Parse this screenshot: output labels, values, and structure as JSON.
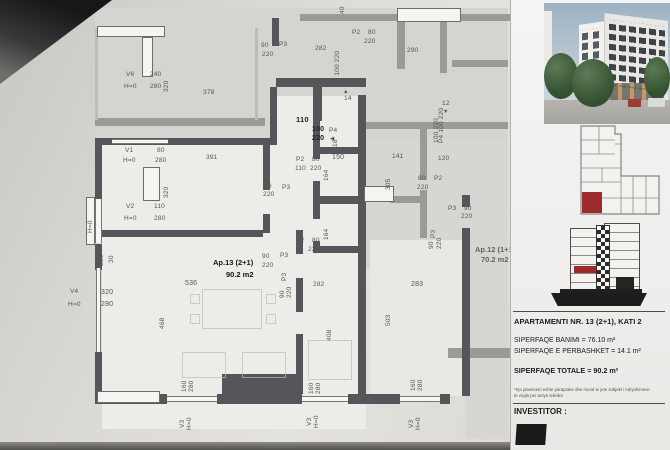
{
  "sidebar": {
    "title": "APARTAMENTI NR. 13 (2+1), KATI 2",
    "line_banimi": "SIPERFAQE BANIMI = 76.10 m²",
    "line_perbashket": "SIPERFAQE E PERBASHKET = 14.1 m²",
    "line_totale": "SIPERFAQE TOTALE = 90.2 m²",
    "note_line1": "*Kjo planimetri eshte paraprake dhe mund te jete subjekt i ndryshimeve",
    "note_line2": "te vogla per arsye teknike",
    "investor_label": "INVESTITOR :"
  },
  "plan": {
    "apartment": {
      "name": "Ap.13 (2+1)",
      "area": "90.2 m2"
    },
    "neighbor": {
      "name": "Ap.12 (1+1)",
      "area": "70.2 m2"
    },
    "labels": [
      {
        "t": "V6",
        "x": 126,
        "y": 71
      },
      {
        "t": "240",
        "x": 150,
        "y": 71
      },
      {
        "t": "H=0",
        "x": 124,
        "y": 83
      },
      {
        "t": "280",
        "x": 150,
        "y": 83
      },
      {
        "t": "320",
        "x": 171,
        "y": 92,
        "r": 1
      },
      {
        "t": "378",
        "x": 203,
        "y": 89
      },
      {
        "t": "90",
        "x": 261,
        "y": 42
      },
      {
        "t": "P3",
        "x": 279,
        "y": 41
      },
      {
        "t": "220",
        "x": 262,
        "y": 51
      },
      {
        "t": "282",
        "x": 315,
        "y": 45
      },
      {
        "t": "P2",
        "x": 352,
        "y": 29
      },
      {
        "t": "80",
        "x": 368,
        "y": 29
      },
      {
        "t": "220",
        "x": 364,
        "y": 38
      },
      {
        "t": "290",
        "x": 407,
        "y": 47
      },
      {
        "t": "40",
        "x": 347,
        "y": 14,
        "r": 1
      },
      {
        "t": "P4 100 220",
        "x": 342,
        "y": 86,
        "r": 1
      },
      {
        "t": "▲",
        "x": 343,
        "y": 88,
        "fs": 5.5
      },
      {
        "t": "14",
        "x": 344,
        "y": 95
      },
      {
        "t": "P4",
        "x": 329,
        "y": 127
      },
      {
        "t": "◀",
        "x": 330,
        "y": 135,
        "fs": 5.5
      },
      {
        "t": "18",
        "x": 340,
        "y": 147,
        "r": 1
      },
      {
        "t": "12",
        "x": 442,
        "y": 100
      },
      {
        "t": "▼",
        "x": 443,
        "y": 108,
        "fs": 5.5
      },
      {
        "t": "P4 100 220",
        "x": 446,
        "y": 143,
        "r": 1
      },
      {
        "t": "110",
        "x": 296,
        "y": 116,
        "b": 1,
        "fs": 7.5
      },
      {
        "t": "100",
        "x": 312,
        "y": 126,
        "b": 1,
        "fs": 7
      },
      {
        "t": "220",
        "x": 312,
        "y": 135,
        "b": 1,
        "fs": 7
      },
      {
        "t": "V1",
        "x": 125,
        "y": 147
      },
      {
        "t": "80",
        "x": 157,
        "y": 147
      },
      {
        "t": "H=0",
        "x": 123,
        "y": 157
      },
      {
        "t": "280",
        "x": 155,
        "y": 157
      },
      {
        "t": "391",
        "x": 206,
        "y": 154
      },
      {
        "t": "320",
        "x": 171,
        "y": 198,
        "r": 1
      },
      {
        "t": "V2",
        "x": 126,
        "y": 203
      },
      {
        "t": "110",
        "x": 154,
        "y": 203
      },
      {
        "t": "H=0",
        "x": 124,
        "y": 215
      },
      {
        "t": "280",
        "x": 154,
        "y": 215
      },
      {
        "t": "H=0",
        "x": 95,
        "y": 233,
        "r": 1
      },
      {
        "t": "280",
        "x": 106,
        "y": 266,
        "r": 1
      },
      {
        "t": "30",
        "x": 116,
        "y": 263,
        "r": 1
      },
      {
        "t": "90",
        "x": 264,
        "y": 183
      },
      {
        "t": "220",
        "x": 263,
        "y": 191
      },
      {
        "t": "P3",
        "x": 282,
        "y": 184
      },
      {
        "t": "P2",
        "x": 296,
        "y": 156
      },
      {
        "t": "80",
        "x": 312,
        "y": 156
      },
      {
        "t": "110",
        "x": 295,
        "y": 165
      },
      {
        "t": "220",
        "x": 310,
        "y": 165
      },
      {
        "t": "150",
        "x": 332,
        "y": 154,
        "fs": 7
      },
      {
        "t": "164",
        "x": 331,
        "y": 181,
        "r": 1
      },
      {
        "t": "164",
        "x": 331,
        "y": 240,
        "r": 1
      },
      {
        "t": "141",
        "x": 392,
        "y": 153
      },
      {
        "t": "305",
        "x": 393,
        "y": 190,
        "r": 1
      },
      {
        "t": "80",
        "x": 418,
        "y": 175
      },
      {
        "t": "P2",
        "x": 434,
        "y": 175
      },
      {
        "t": "220",
        "x": 417,
        "y": 184
      },
      {
        "t": "100 220",
        "x": 441,
        "y": 143,
        "r": 1
      },
      {
        "t": "120",
        "x": 438,
        "y": 155
      },
      {
        "t": "P2",
        "x": 296,
        "y": 237
      },
      {
        "t": "80",
        "x": 312,
        "y": 237
      },
      {
        "t": "220",
        "x": 308,
        "y": 246
      },
      {
        "t": "90",
        "x": 262,
        "y": 253
      },
      {
        "t": "P3",
        "x": 280,
        "y": 252
      },
      {
        "t": "220",
        "x": 262,
        "y": 262
      },
      {
        "t": "P3",
        "x": 289,
        "y": 281,
        "r": 1
      },
      {
        "t": "90",
        "x": 287,
        "y": 298,
        "r": 1
      },
      {
        "t": "220",
        "x": 294,
        "y": 298,
        "r": 1
      },
      {
        "t": "282",
        "x": 313,
        "y": 281
      },
      {
        "t": "P3",
        "x": 448,
        "y": 205
      },
      {
        "t": "90",
        "x": 464,
        "y": 205
      },
      {
        "t": "220",
        "x": 461,
        "y": 213
      },
      {
        "t": "P3",
        "x": 438,
        "y": 238,
        "r": 1
      },
      {
        "t": "90",
        "x": 436,
        "y": 249,
        "r": 1
      },
      {
        "t": "220",
        "x": 444,
        "y": 249,
        "r": 1
      },
      {
        "t": "536",
        "x": 185,
        "y": 280,
        "fs": 7
      },
      {
        "t": "468",
        "x": 167,
        "y": 329,
        "r": 1
      },
      {
        "t": "408",
        "x": 334,
        "y": 341,
        "r": 1
      },
      {
        "t": "283",
        "x": 411,
        "y": 281,
        "fs": 7
      },
      {
        "t": "503",
        "x": 393,
        "y": 326,
        "r": 1
      },
      {
        "t": "V4",
        "x": 70,
        "y": 288
      },
      {
        "t": "320",
        "x": 101,
        "y": 289,
        "fs": 7
      },
      {
        "t": "H=0",
        "x": 68,
        "y": 301
      },
      {
        "t": "280",
        "x": 101,
        "y": 301,
        "fs": 7
      },
      {
        "t": "160",
        "x": 189,
        "y": 392,
        "r": 1
      },
      {
        "t": "280",
        "x": 196,
        "y": 392,
        "r": 1
      },
      {
        "t": "V3",
        "x": 187,
        "y": 428,
        "r": 1
      },
      {
        "t": "H=0",
        "x": 194,
        "y": 430,
        "r": 1
      },
      {
        "t": "160",
        "x": 316,
        "y": 394,
        "r": 1
      },
      {
        "t": "280",
        "x": 323,
        "y": 394,
        "r": 1
      },
      {
        "t": "V3",
        "x": 314,
        "y": 426,
        "r": 1
      },
      {
        "t": "H=0",
        "x": 321,
        "y": 428,
        "r": 1
      },
      {
        "t": "160",
        "x": 418,
        "y": 391,
        "r": 1
      },
      {
        "t": "280",
        "x": 425,
        "y": 391,
        "r": 1
      },
      {
        "t": "V3",
        "x": 416,
        "y": 428,
        "r": 1
      },
      {
        "t": "H=0",
        "x": 423,
        "y": 430,
        "r": 1
      }
    ]
  },
  "colors": {
    "highlight_red": "#9e2a2e",
    "wall_dark": "#56565a",
    "wall_gray": "#9b9a95",
    "paper": "#e3e2de"
  }
}
